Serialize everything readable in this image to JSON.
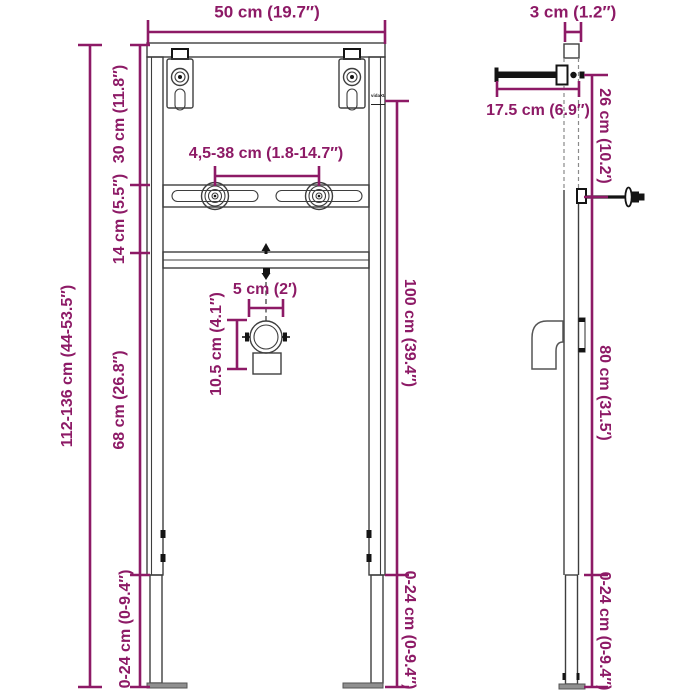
{
  "colors": {
    "bg": "#ffffff",
    "accent": "#8d1a66",
    "line": "#3e3e3e",
    "dark": "#141414",
    "metal": "#909090"
  },
  "logo": "vidaXL",
  "front": {
    "width": "50 cm (19.7″)",
    "overall_height": "112-136 cm (44-53.5″)",
    "seg_top": "30 cm (11.8″)",
    "seg_rail": "14 cm (5.5″)",
    "seg_body": "68 cm (26.8″)",
    "seg_leg_left": "0-24 cm (0-9.4″)",
    "bracket_range": "4,5-38 cm (1.8-14.7″)",
    "pipe_offset": "5 cm (2′)",
    "pipe_height": "10.5 cm (4.1″)",
    "frame_height": "100 cm (39.4″)",
    "seg_leg_right": "0-24 cm (0-9.4″)"
  },
  "side": {
    "depth": "3 cm (1.2″)",
    "arm_length": "17.5 cm (6.9″)",
    "seg_upper": "26 cm (10.2′)",
    "seg_lower": "80 cm (31.5′)",
    "seg_leg": "0-24 cm (0-9.4″)"
  }
}
